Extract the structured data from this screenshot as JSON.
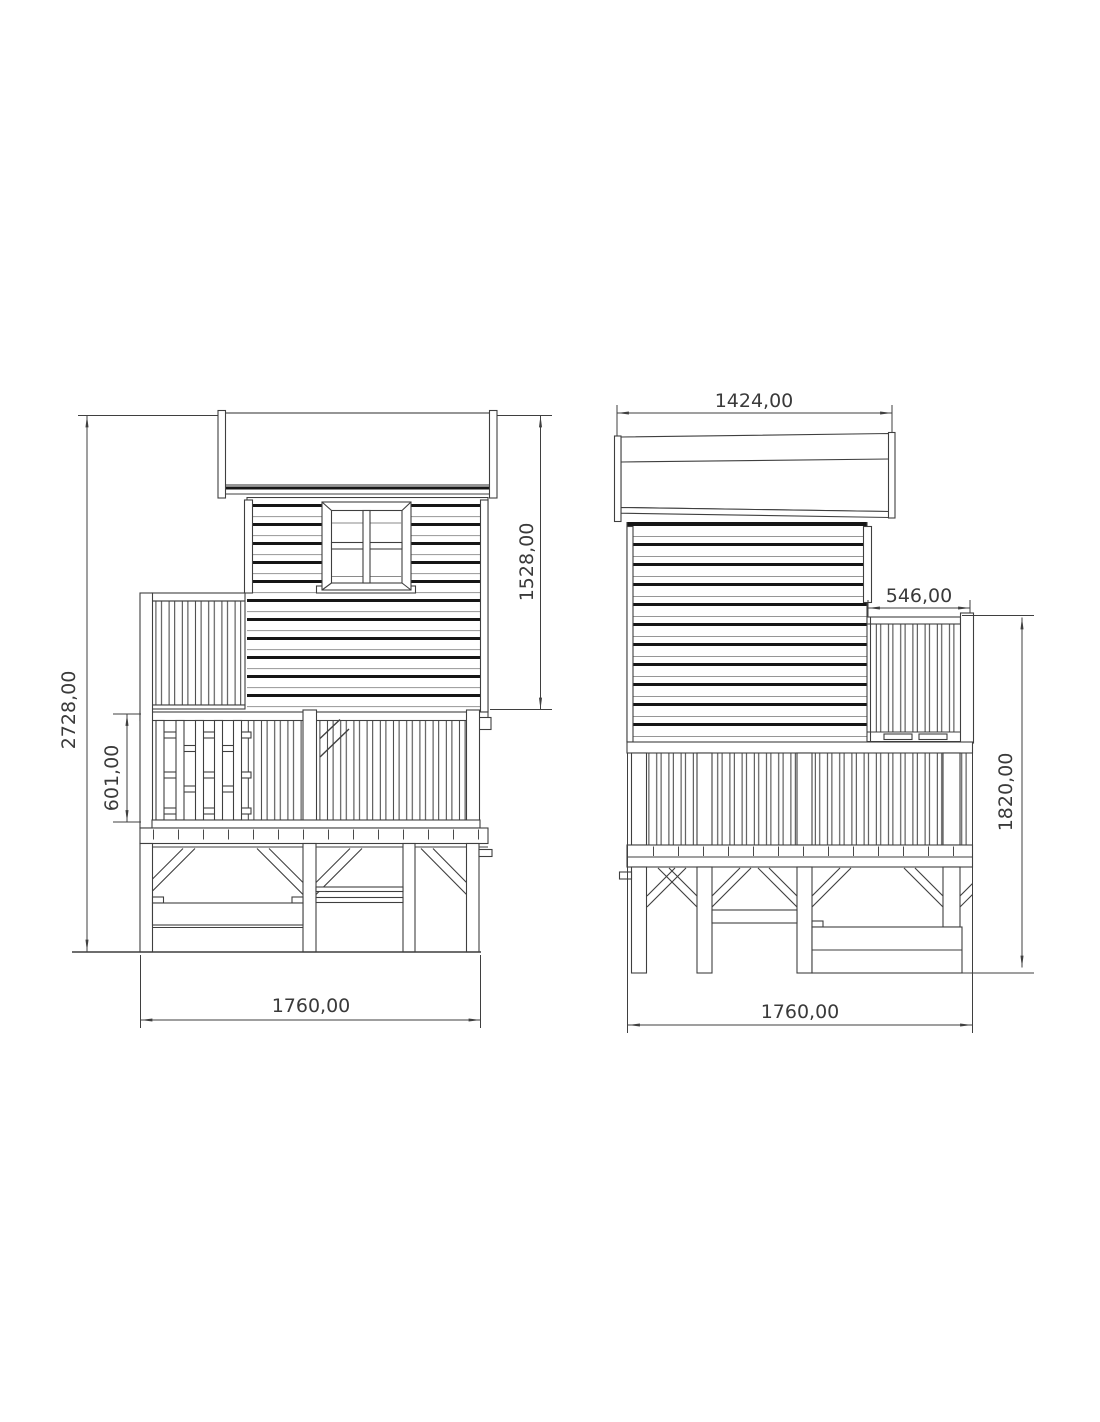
{
  "views": {
    "front": {
      "dims": {
        "total_height": "2728,00",
        "house_height": "1528,00",
        "railing_height": "601,00",
        "base_width": "1760,00"
      }
    },
    "side": {
      "dims": {
        "roof_width": "1424,00",
        "balcony_depth": "546,00",
        "platform_height": "1820,00",
        "base_width": "1760,00"
      }
    }
  },
  "colors": {
    "background": "#ffffff",
    "line": "#3f3f3f",
    "heavy_line": "#161616",
    "dimension_text": "#3a3a3a"
  }
}
